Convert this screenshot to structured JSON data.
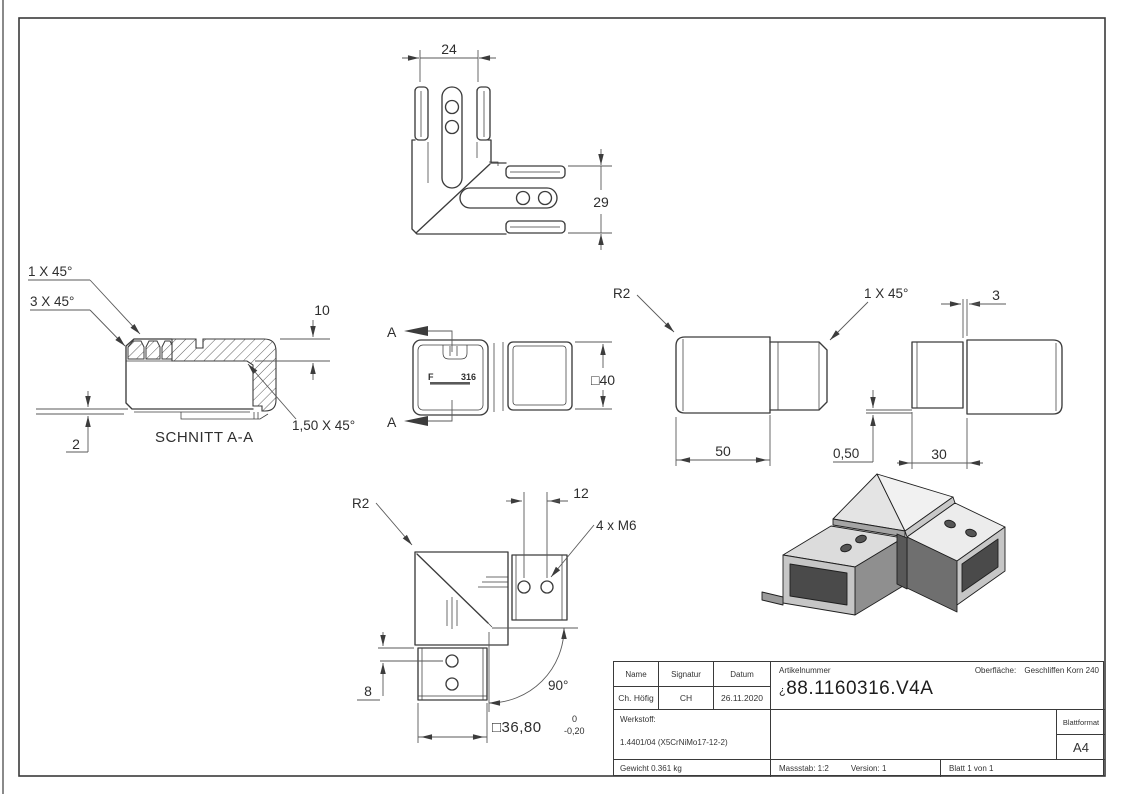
{
  "views": {
    "top": {
      "dim_width": "24",
      "dim_height": "29"
    },
    "section": {
      "chamfer_small": "1 X 45°",
      "chamfer_large": "3 X 45°",
      "dim_depth": "10",
      "dim_wall": "2",
      "chamfer_inner": "1,50 X 45°",
      "caption": "SCHNITT A-A"
    },
    "front": {
      "cut_label": "A",
      "stamp_f": "F",
      "stamp_code": "316",
      "dim_square": "□40"
    },
    "side_left": {
      "radius": "R2",
      "dim_length": "50"
    },
    "side_right": {
      "chamfer": "1 X 45°",
      "dim_gap": "3",
      "dim_step": "0,50",
      "dim_insert": "30"
    },
    "bottom": {
      "radius": "R2",
      "dim_holes": "12",
      "thread": "4 x M6",
      "dim_angle": "90°",
      "dim_offset": "8",
      "dim_square": "□36,80",
      "tol_upper": "0",
      "tol_lower": "-0,20"
    }
  },
  "title_block": {
    "headers": {
      "name": "Name",
      "signatur": "Signatur",
      "datum": "Datum",
      "artikelnummer": "Artikelnummer",
      "oberflaeche_label": "Oberfläche:",
      "oberflaeche_value": "Geschliffen Korn 240",
      "blattformat": "Blattformat"
    },
    "values": {
      "name": "Ch. Höfig",
      "signatur": "CH",
      "datum": "26.11.2020",
      "artikelnummer_prefix": "¿",
      "artikelnummer": "88.1160316.V4A",
      "blattformat": "A4"
    },
    "werkstoff_label": "Werkstoff:",
    "werkstoff_value": "1.4401/04 (X5CrNiMo17-12-2)",
    "gewicht": "Gewicht 0.361 kg",
    "massstab": "Massstab: 1:2",
    "version": "Version: 1",
    "blatt": "Blatt 1 von 1"
  }
}
